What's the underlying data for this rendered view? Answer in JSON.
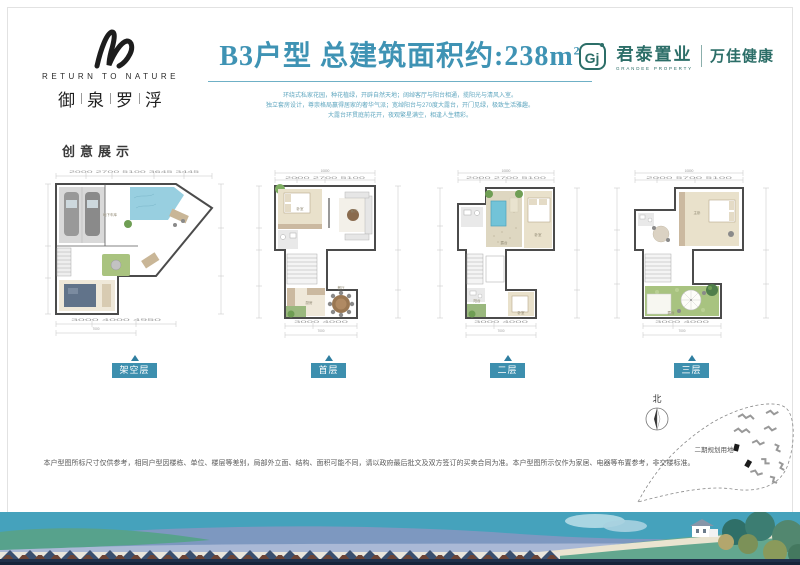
{
  "brand": {
    "name_en": "RETURN TO NATURE",
    "chars": [
      "御",
      "泉",
      "罗",
      "浮"
    ]
  },
  "title": {
    "main": "B3户型 总建筑面积约:238m",
    "sup": "2",
    "desc1": "环绕式私家花园，种花植绿，开辟自然天地；阔绰客厅与阳台相通，揽阳光与清风入室。",
    "desc2": "独立套房设计，尊崇格局赢得居家的奢华气派；宽绰阳台与270度大露台，开门见绿，极致生活雅趣。",
    "desc3": "大露台环贯庭前花开，夜观繁星满空，相逢人生精彩。"
  },
  "developer": {
    "monogram": "Gj",
    "name_cn": "君泰置业",
    "name_en": "GRANDEE PROPERTY",
    "partner": "万佳健康"
  },
  "section_label": "创意展示",
  "floors": [
    {
      "label": "架空层",
      "rooms": {
        "r1": "地下车库"
      },
      "dims": {
        "t": "2000  2700  5100  3645  3445",
        "b1": "3000   4000   4950",
        "b2": "7000"
      }
    },
    {
      "label": "首层",
      "rooms": {
        "r1": "卧室",
        "r2": "客厅",
        "r3": "厨房",
        "r4": "餐厅"
      },
      "dims": {
        "tt": "10800",
        "t": "2000   2700   5100",
        "b1": "3000   4000",
        "b2": "7000"
      }
    },
    {
      "label": "二层",
      "rooms": {
        "r1": "露台",
        "r2": "卧室",
        "r3": "卧室",
        "r4": "阳台"
      },
      "dims": {
        "tt": "10800",
        "t": "2000   2700   5100",
        "b1": "3000   4000",
        "b2": "7000"
      }
    },
    {
      "label": "三层",
      "rooms": {
        "r1": "主卧",
        "r2": "露台"
      },
      "dims": {
        "tt": "10800",
        "t": "2000   5700   5100",
        "b1": "3000   4000",
        "b2": "7000"
      }
    }
  ],
  "disclaimer": "本户型图所标尺寸仅供参考，相同户型因楼栋、单位、楼层等差别，局部外立面、结构、面积可能不同，请以政府最后批文及双方签订的买卖合同为准。本户型图所示仅作为家居、电器等布置参考，非交楼标准。",
  "siteplan": {
    "north": "北",
    "label": "二期规划用地"
  },
  "colors": {
    "accent": "#3f93b4",
    "badge": "#3d8fae",
    "developer": "#2c6e68"
  }
}
